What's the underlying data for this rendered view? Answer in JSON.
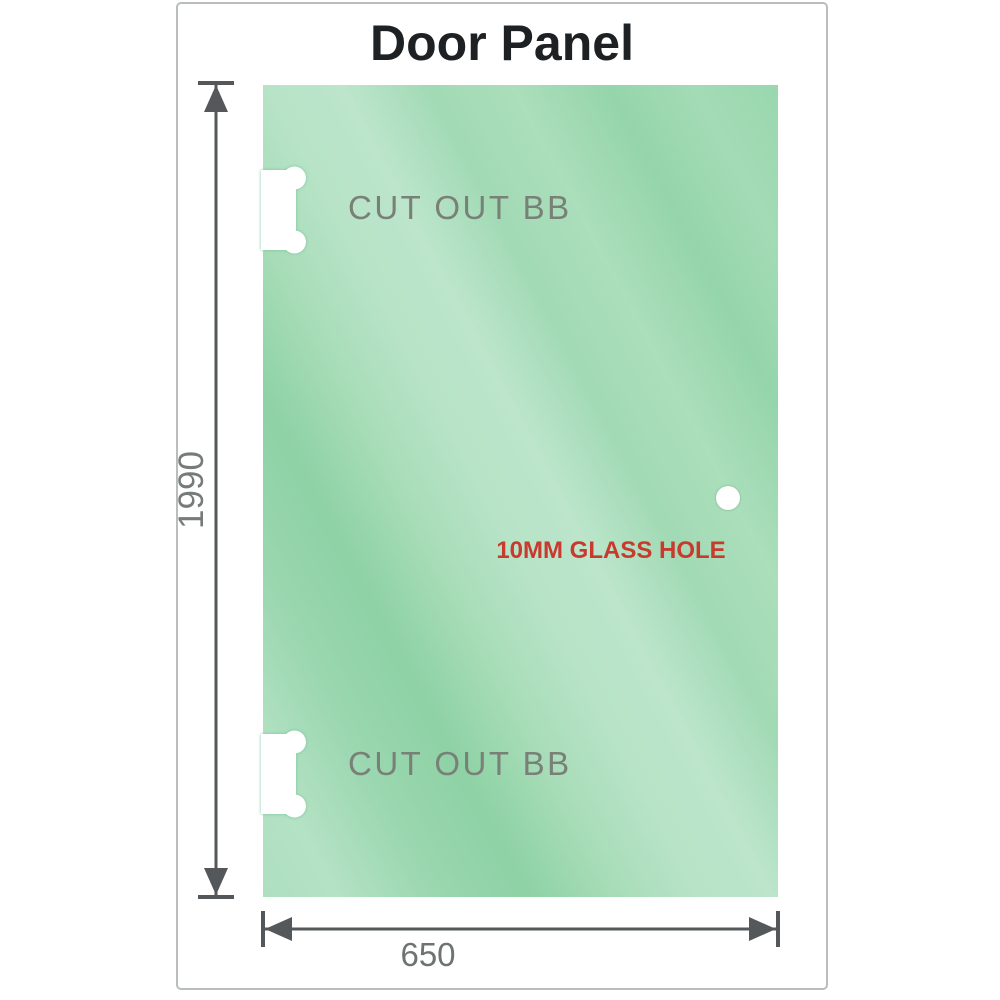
{
  "title": "Door Panel",
  "panel": {
    "description": "glass door panel drawing",
    "cutouts": [
      {
        "label": "CUT OUT BB",
        "position": "top-left"
      },
      {
        "label": "CUT OUT BB",
        "position": "bottom-left"
      }
    ],
    "hole": {
      "label": "10MM GLASS HOLE"
    }
  },
  "dimensions": {
    "height": {
      "value": "1990",
      "orientation": "vertical"
    },
    "width": {
      "value": "650",
      "orientation": "horizontal"
    }
  },
  "colors": {
    "panel_green_dark": "#8ed2a5",
    "panel_green_light": "#bce5cb",
    "title_color": "#1e2124",
    "label_gray": "#798078",
    "dimension_gray": "#54585a",
    "annotation_red": "#c8392e",
    "frame_border": "#babdbd",
    "cutout_fill": "#ffffff"
  },
  "icons": {
    "cutout_shape": "dog-bone-notch-icon",
    "hole_shape": "circle-hole-icon"
  }
}
